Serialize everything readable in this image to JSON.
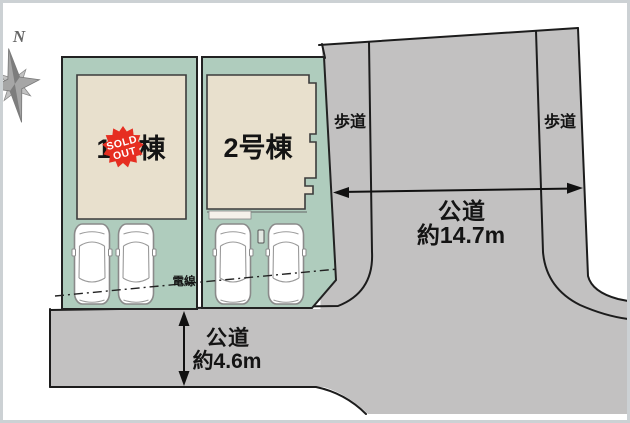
{
  "plan": {
    "compass": {
      "north_label": "N"
    },
    "lots": {
      "lot1": {
        "label": "1号棟"
      },
      "lot2": {
        "label": "2号棟"
      }
    },
    "badge": {
      "line1": "SOLD",
      "line2": "OUT"
    },
    "roads": {
      "right_road": {
        "name": "公道",
        "width": "約14.7m"
      },
      "bottom_road": {
        "name": "公道",
        "width": "約4.6m"
      },
      "sidewalk_left": "歩道",
      "sidewalk_right": "歩道"
    },
    "powerline": {
      "label": "電線"
    },
    "colors": {
      "lot_green": "#afccbd",
      "building_beige": "#e8e0cd",
      "road_gray": "#c2c1c1",
      "sold_red": "#e62e21",
      "car_white": "#ffffff",
      "compass_gray": "#a6a6a6"
    }
  }
}
